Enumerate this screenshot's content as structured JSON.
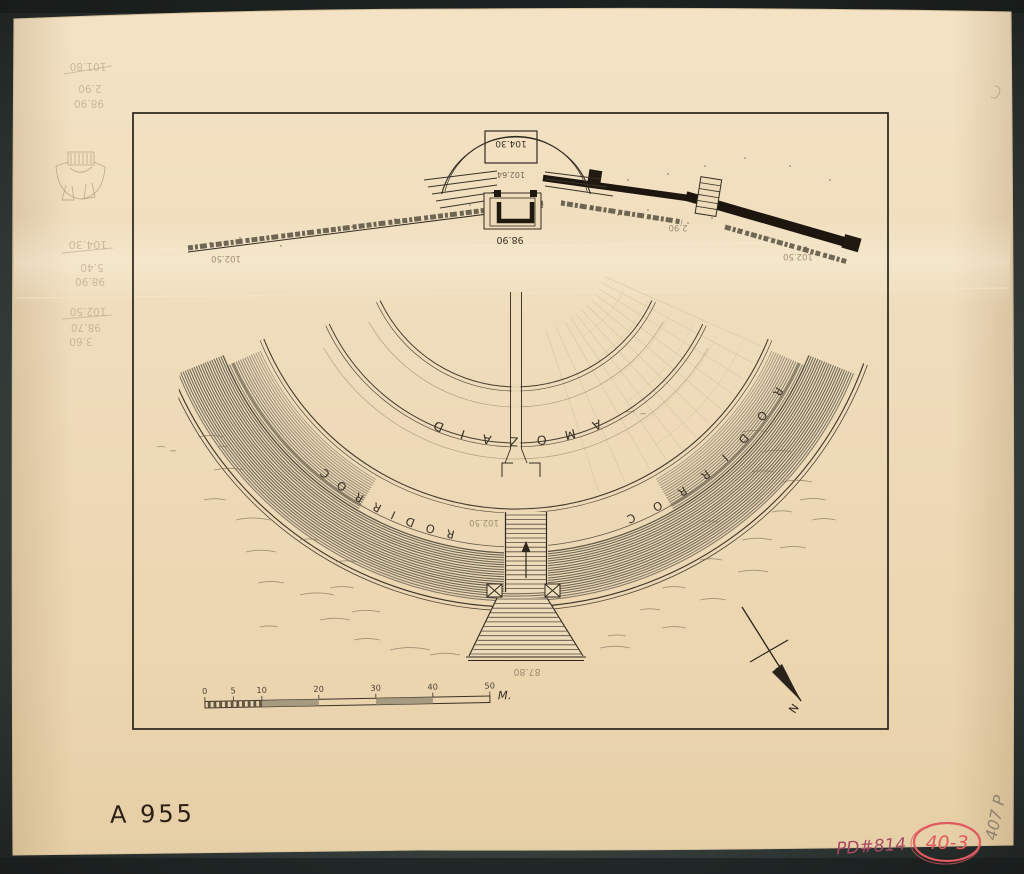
{
  "plan": {
    "labels": {
      "diazoma": "DIAZOMA",
      "corridor_left": "CORRIDOR",
      "corridor_right": "CORRIDOR"
    },
    "levels": {
      "stage": "104.30",
      "terrace": "102.64",
      "orchestra": "98.90",
      "corridor_left": "102.50",
      "corridor_right": "102.50",
      "corridor_bottom": "102.50",
      "wall": "2.90",
      "stairs_base": "87.80"
    }
  },
  "scale_bar": {
    "ticks": [
      "0",
      "5",
      "10",
      "20",
      "30",
      "40",
      "50"
    ],
    "unit": "M."
  },
  "compass": {
    "label": "N"
  },
  "annotations": {
    "catalog_number": "A 955",
    "pd_number": "PD#814",
    "circled_number": "40-3",
    "corner_number": "407 P",
    "margin_notes_top": [
      "101.80",
      "2.90",
      "98.90"
    ],
    "margin_notes_mid": [
      "104.30",
      "5.40",
      "98.90"
    ],
    "margin_notes_low": [
      "102.50",
      "98.70",
      "3.60"
    ]
  }
}
